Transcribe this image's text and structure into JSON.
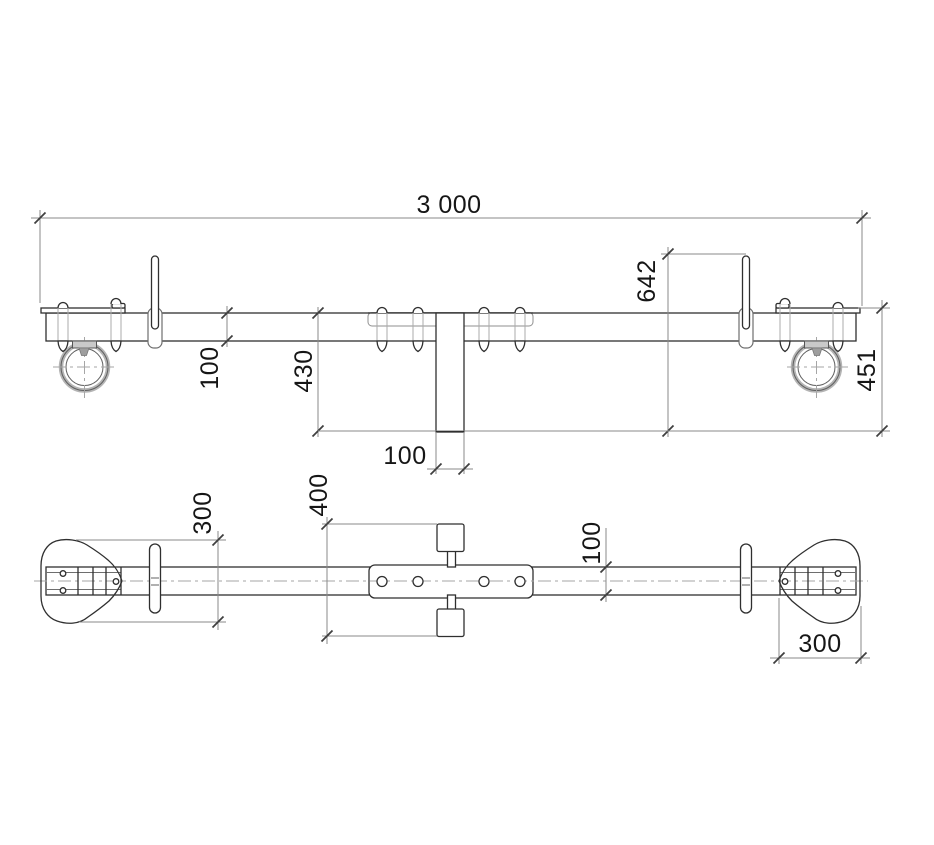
{
  "drawing": {
    "front_view": {
      "dim_overall_length": "3 000",
      "dim_pin_height": "642",
      "dim_beam_depth": "100",
      "dim_post_drop": "430",
      "dim_end_drop": "451",
      "dim_post_width": "100"
    },
    "plan_view": {
      "dim_left_paddle": "300",
      "dim_clamp_span": "400",
      "dim_bar_width": "100",
      "dim_right_paddle": "300"
    },
    "colors": {
      "outline": "#2f2f2f",
      "dimension_lines": "#8a8a8a",
      "centerline": "#a6a6a6",
      "wheel_ring": "#b4b4b4"
    }
  }
}
